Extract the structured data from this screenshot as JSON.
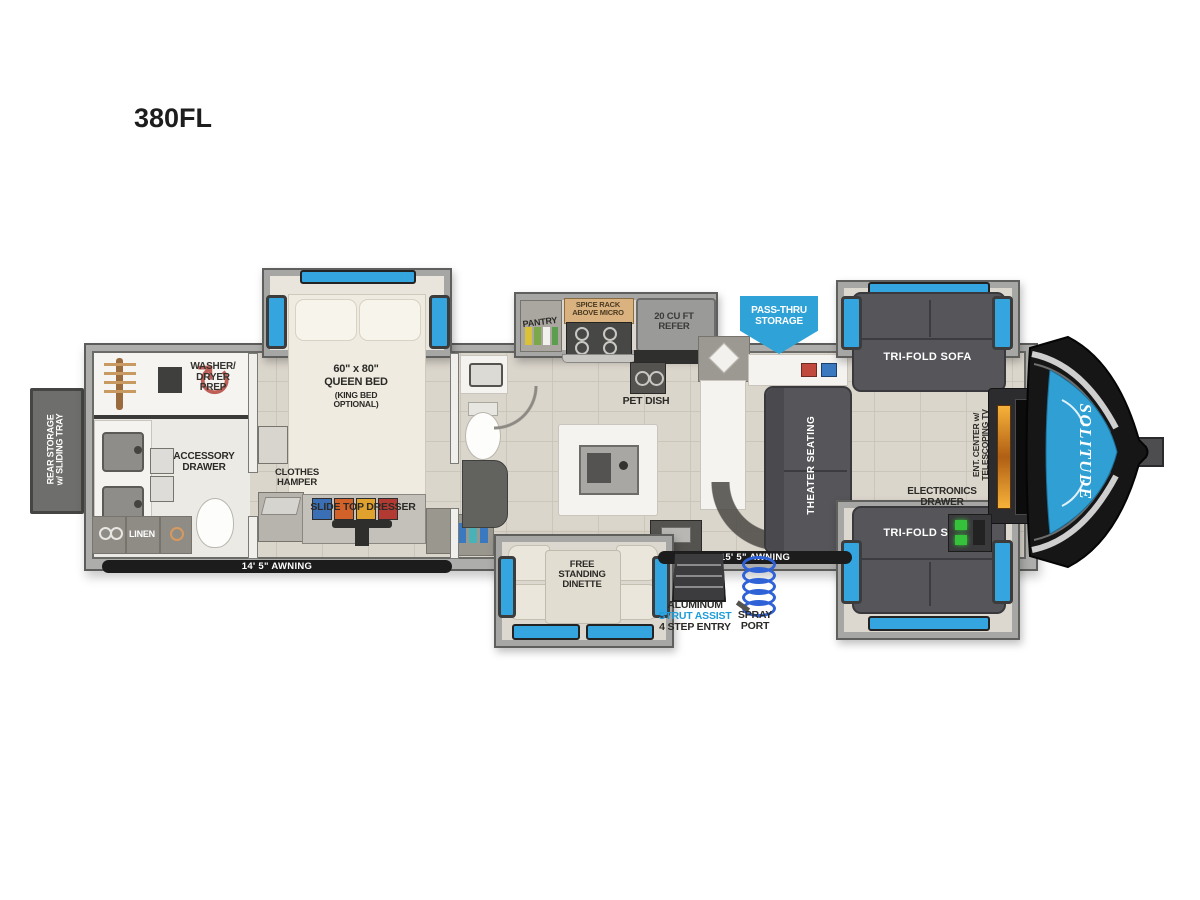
{
  "title": "380FL",
  "brand": "SOLITUDE",
  "colors": {
    "accent_blue": "#2fa3d8",
    "window_blue": "#35a5e0",
    "label_dark": "#2b2a27",
    "awning_black": "#1c1c1c",
    "strut_blue": "#1e9cd8",
    "sofa_gray": "#55555a",
    "floor_tile": "#dbd6cc"
  },
  "exterior": {
    "rear_storage": "REAR STORAGE\nw/ SLIDING TRAY",
    "pass_thru": "PASS-THRU\nSTORAGE",
    "awning_left": "14' 5\" AWNING",
    "awning_right": "15' 5\" AWNING",
    "entry_line1": "ALUMINUM",
    "entry_line2": "STRUT ASSIST",
    "entry_line3": "4 STEP ENTRY",
    "spray_port": "SPRAY\nPORT"
  },
  "bath": {
    "washer_dryer": "WASHER/\nDRYER\nPREP",
    "accessory_drawer": "ACCESSORY\nDRAWER",
    "linen": "LINEN"
  },
  "bedroom": {
    "bed_size": "60\" x 80\"",
    "bed_name": "QUEEN BED",
    "bed_option": "(KING BED\nOPTIONAL)",
    "clothes_hamper": "CLOTHES\nHAMPER",
    "dresser": "SLIDE TOP DRESSER"
  },
  "kitchen": {
    "pantry": "PANTRY",
    "spice_rack": "SPICE RACK\nABOVE MICRO",
    "refer": "20 CU FT\nREFER",
    "pet_dish": "PET DISH",
    "dinette": "FREE\nSTANDING\nDINETTE"
  },
  "living": {
    "theater": "THEATER SEATING",
    "sofa_top": "TRI-FOLD SOFA",
    "sofa_bottom": "TRI-FOLD SOFA",
    "ent_center": "ENT. CENTER w/\nTELESCOPING TV",
    "electronics": "ELECTRONICS\nDRAWER"
  }
}
